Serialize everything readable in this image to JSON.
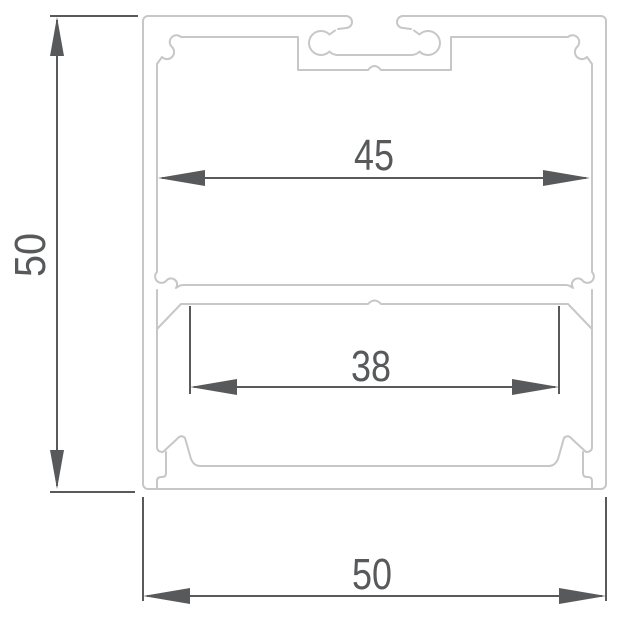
{
  "drawing": {
    "dims": {
      "height": "50",
      "inner_width": "45",
      "slot_width": "38",
      "outer_width": "50"
    },
    "colors": {
      "profile_line": "#c6c7c9",
      "dimension": "#58595b",
      "background": "#ffffff"
    }
  }
}
